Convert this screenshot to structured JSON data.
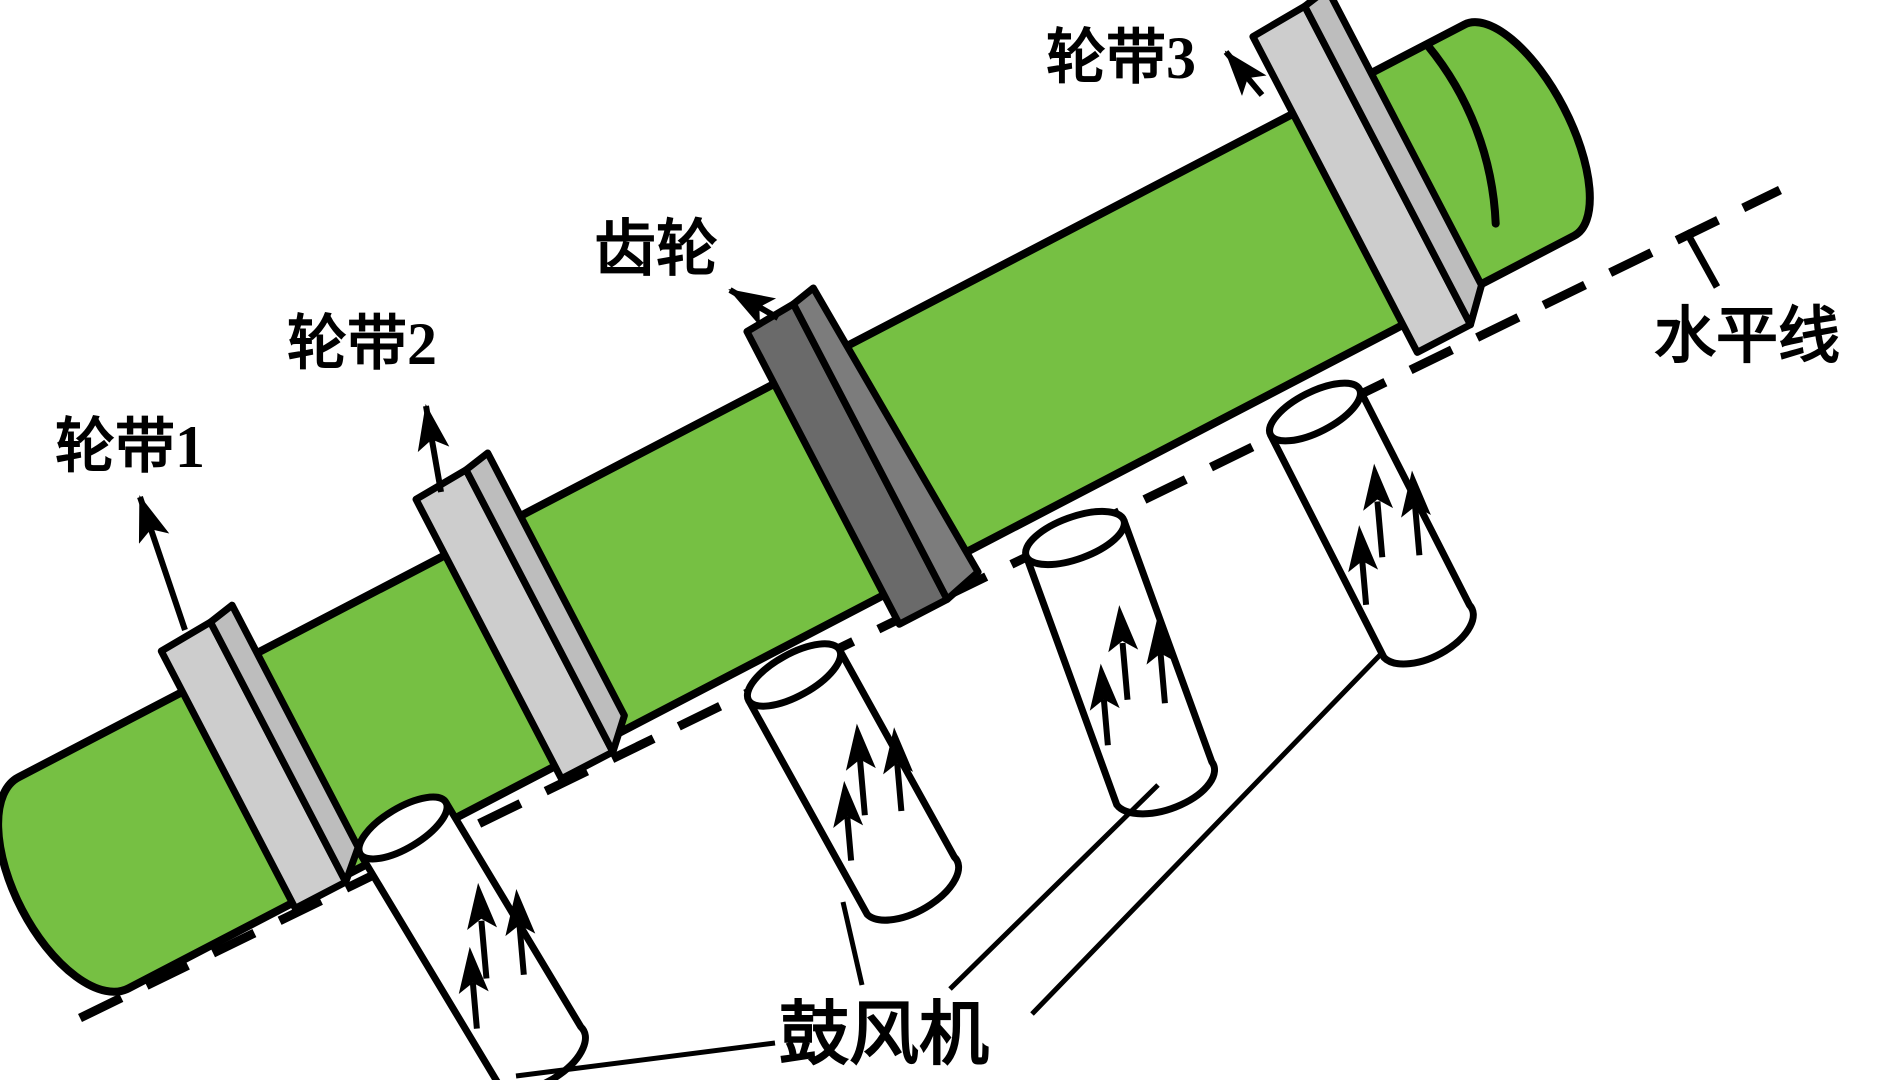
{
  "labels": {
    "ring1": "轮带1",
    "ring2": "轮带2",
    "ring3": "轮带3",
    "gear": "齿轮",
    "horizontal_line": "水平线",
    "blower": "鼓风机"
  },
  "colors": {
    "cylinder_green": "#76C043",
    "ring_gray": "#CDCDCD",
    "ring_side_gray": "#BDBDBD",
    "gear_dark": "#6A6A6A",
    "gear_side_gray": "#7C7C7C",
    "outline": "#000000",
    "background": "#FFFFFF"
  },
  "diagram": {
    "blower_count": 4,
    "airflow_arrows_per_blower": 3,
    "ring_count": 3,
    "incline_reference": "dashed line parallel to cylinder with angle tick toward horizontal-line label"
  }
}
